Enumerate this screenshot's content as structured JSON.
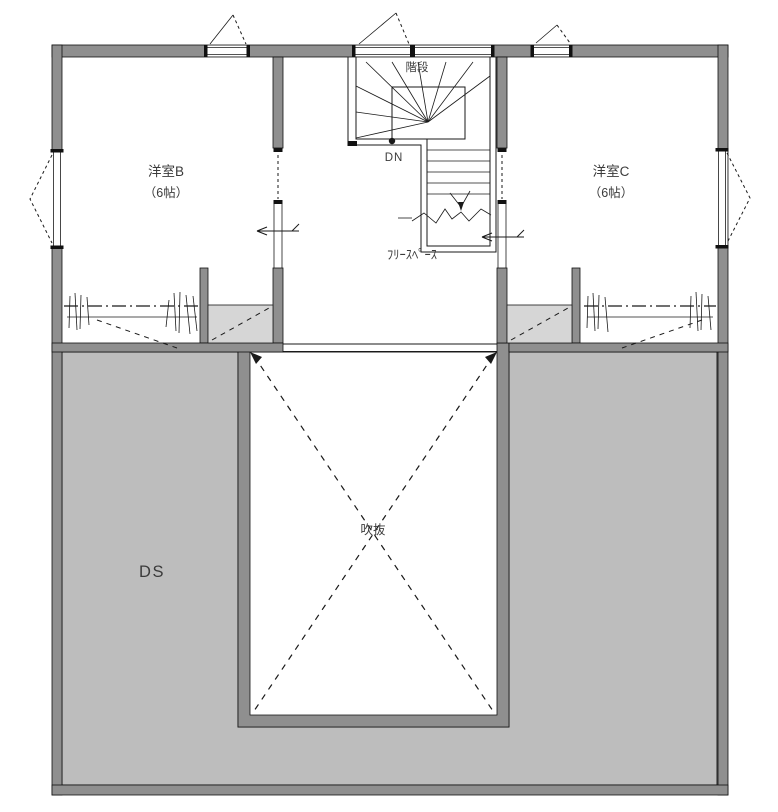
{
  "plan": {
    "rooms": {
      "room_b": {
        "label": "洋室B",
        "size": "（6帖）"
      },
      "room_c": {
        "label": "洋室C",
        "size": "（6帖）"
      },
      "free_space": {
        "label": "ﾌﾘｰｽﾍﾟｰｽ"
      },
      "stairs": {
        "label": "階段",
        "down_label": "DN"
      },
      "void": {
        "label": "吹抜"
      },
      "duct_space": {
        "label": "DS"
      }
    },
    "colors": {
      "wall": "#8f8f8f",
      "shaded_area": "#bdbdbd",
      "storage_box": "#d6d6d6",
      "line": "#1a1a1a",
      "text": "#3b3b3b"
    }
  }
}
